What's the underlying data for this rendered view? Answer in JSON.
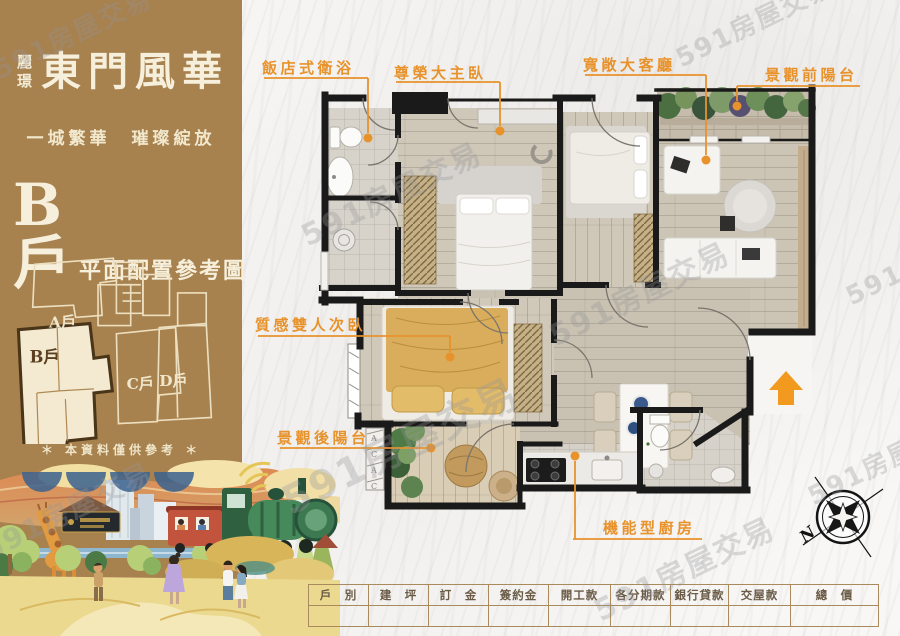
{
  "brand": {
    "logo_small": "麗璟",
    "title": "東門風華",
    "slogan": "一城繁華　璀璨綻放",
    "unit_label": "B戶",
    "plan_caption": "平面配置參考圖",
    "disclaimer": "＊ 本資料僅供參考 ＊"
  },
  "keyplan": {
    "units": [
      {
        "label": "A戶"
      },
      {
        "label": "B戶"
      },
      {
        "label": "C戶"
      },
      {
        "label": "D戶"
      }
    ]
  },
  "plan": {
    "labels": [
      {
        "text": "飯店式衛浴"
      },
      {
        "text": "尊榮大主臥"
      },
      {
        "text": "寬敞大客廳"
      },
      {
        "text": "景觀前陽台"
      },
      {
        "text": "質感雙人次臥"
      },
      {
        "text": "景觀後陽台"
      },
      {
        "text": "機能型廚房"
      }
    ],
    "ac": [
      "A",
      "C",
      "A",
      "C"
    ],
    "accent_color": "#e8922c"
  },
  "compass": {
    "north": "N"
  },
  "price_table": {
    "headers": [
      "戶　別",
      "建　坪",
      "訂　金",
      "簽約金",
      "開工款",
      "各分期款",
      "銀行貸款",
      "交屋款",
      "總　價"
    ],
    "row": [
      "",
      "",
      "",
      "",
      "",
      "",
      "",
      "",
      ""
    ]
  },
  "watermark": {
    "text": "591房屋交易"
  },
  "colors": {
    "panel_brown": "#a7814e",
    "label_orange": "#e8922c",
    "table_border": "#a98a5c",
    "cream": "#f3ecd7",
    "wall_black": "#1a1a1a"
  }
}
